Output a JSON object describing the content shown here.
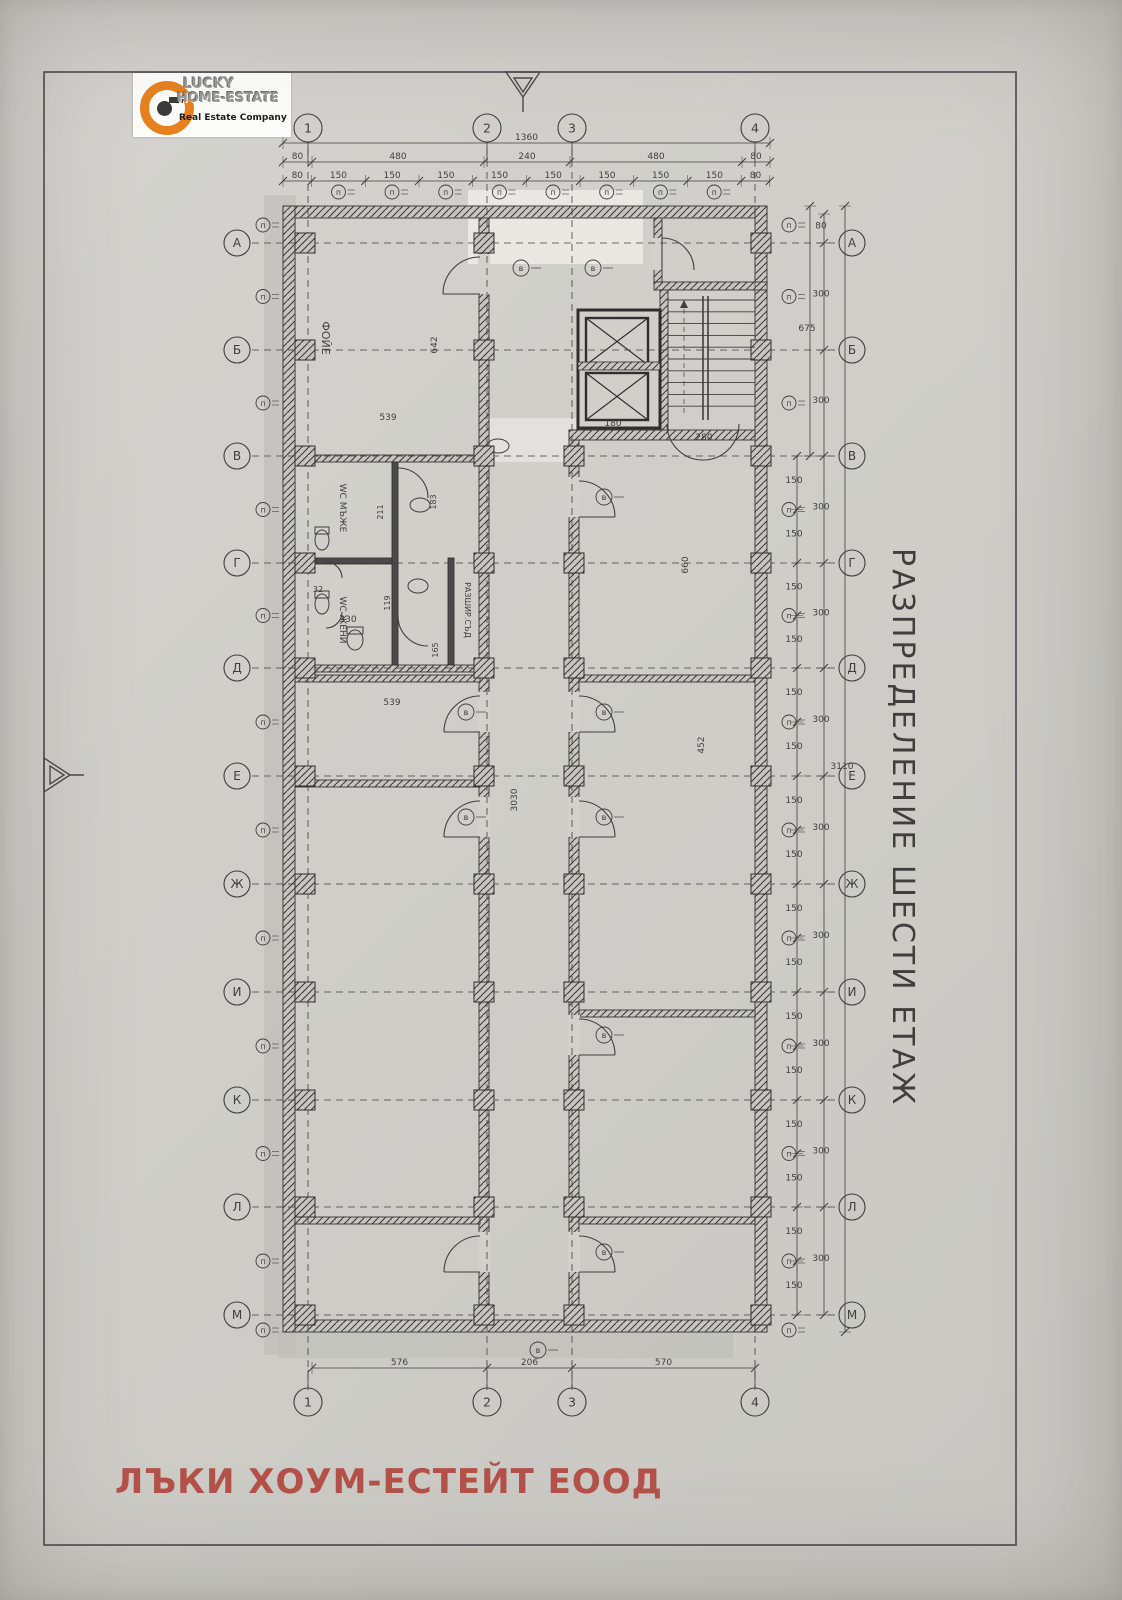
{
  "page": {
    "drawing_title": "РАЗПРЕДЕЛЕНИЕ ШЕСТИ ЕТАЖ",
    "footer_company": "ЛЪКИ ХОУМ-ЕСТЕЙТ ЕООД"
  },
  "logo": {
    "top": "LUCKY",
    "bottom": "HOME-ESTATE",
    "tagline": "Real Estate Company"
  },
  "grid": {
    "cols": [
      "1",
      "2",
      "3",
      "4"
    ],
    "rows": [
      "А",
      "Б",
      "В",
      "Г",
      "Д",
      "Е",
      "Ж",
      "И",
      "К",
      "Л",
      "М"
    ]
  },
  "rooms": {
    "foyer": "ФОЙЕ",
    "wc_men": "WC МЪЖЕ",
    "wc_women": "WC ЖЕНИ",
    "expansion": "РАЗШИР.СЪД"
  },
  "tags": {
    "window": "п",
    "door": "в"
  },
  "dims": {
    "top_total": "1360",
    "top_major": [
      "80",
      "480",
      "240",
      "480",
      "80"
    ],
    "top_minor": [
      "80",
      "150",
      "150",
      "150",
      "150",
      "150",
      "150",
      "150",
      "150",
      "80"
    ],
    "bottom": [
      "576",
      "206",
      "570"
    ],
    "right_pairs": [
      "80",
      "300",
      "300",
      "300",
      "300",
      "300",
      "300",
      "300",
      "300",
      "300",
      "300"
    ],
    "right_steps": "150",
    "right_partial": "675",
    "right_total": "3110",
    "interior": {
      "foyer_w": "539",
      "foyer_h": "642",
      "hall_len": "3030",
      "left_w": "539",
      "wc_w": "330",
      "wc_a": "32",
      "wc_b": "211",
      "wc_c": "183",
      "wc_d": "119",
      "wc_e": "165",
      "elev_w": "180",
      "stair_w": "280",
      "right_a": "660",
      "right_b": "452"
    }
  }
}
